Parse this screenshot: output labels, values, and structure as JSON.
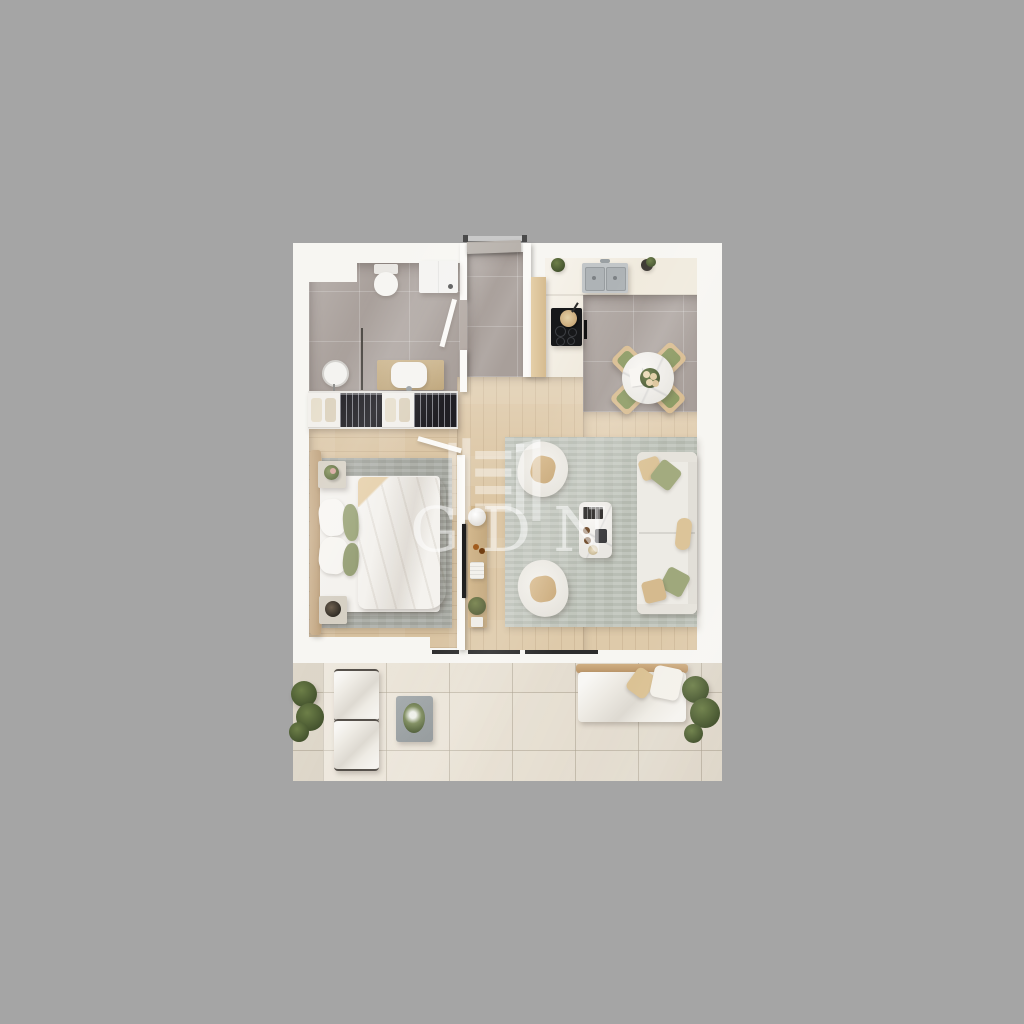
{
  "scene": {
    "type": "3d-rendered top-down floor plan of a one-bedroom apartment with balcony",
    "background_color": "#a5a5a5",
    "card_color": "#f7f6f2"
  },
  "watermark": {
    "text": "GDN"
  },
  "palette": {
    "tile_gray": "#a89f9a",
    "wood_floor": "#dcc6a4",
    "kitchen_cream": "#f0eadd",
    "living_rug": "#b9beb4",
    "bedroom_rug": "#a6a8a1",
    "balcony_tile": "#e9e2d5",
    "blanket_tan": "#d2b186",
    "pillow_green": "#9fa87e",
    "dining_cushion_olive": "#8c9a63",
    "sofa_white": "#edebe5",
    "tv_black": "#1e1e1e",
    "counter_steel": "#c2c6c8"
  },
  "rooms": [
    "bathroom",
    "entry-hall",
    "kitchen",
    "dining-area",
    "living-room",
    "bedroom",
    "balcony"
  ]
}
